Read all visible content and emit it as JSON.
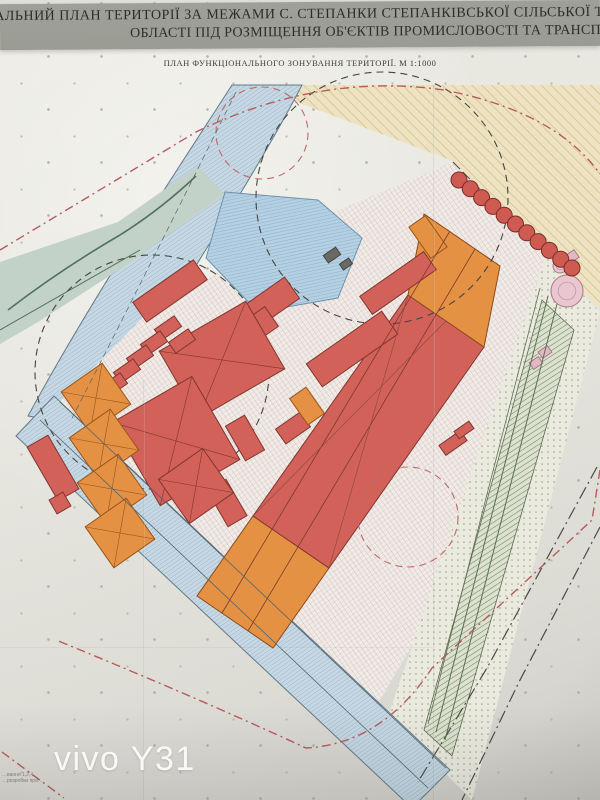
{
  "header": {
    "line1": "ТАЛЬНИЙ ПЛАН ТЕРИТОРІЇ ЗА МЕЖАМИ С. СТЕПАНКИ СТЕПАНКІВСЬКОЇ СІЛЬСЬКОЇ ТЕРИТОР",
    "line2": "ОБЛАСТІ ПІД РОЗМІЩЕННЯ ОБ'ЄКТІВ ПРОМИСЛОВОСТІ ТА ТРАНСПОРТ",
    "subtitle": "ПЛАН ФУНКЦІОНАЛЬНОГО ЗОНУВАННЯ ТЕРИТОРІЇ. М 1:1000"
  },
  "photo": {
    "watermark": "vivo Y31"
  },
  "footnote": {
    "line1": "…вання 1,2,4",
    "line2": "…розробки про…"
  },
  "palette": {
    "paper": "#e6e5de",
    "title_band": "#a2a39b",
    "cream_zone": "#ede3c3",
    "road_blue": "#c6d8e3",
    "pond_blue": "#b5d0e2",
    "building_red": "#d2615a",
    "building_orange": "#e59143",
    "tree_red": "#ce5a52",
    "boundary_red": "#b85b5e",
    "boundary_black": "#4b4b45",
    "marker_fill": "#f8f7f1"
  },
  "map": {
    "markers": [
      {
        "n": "43",
        "x": 184,
        "y": 195
      },
      {
        "n": "36",
        "x": 232,
        "y": 244
      },
      {
        "n": "37",
        "x": 195,
        "y": 258
      },
      {
        "n": "42",
        "x": 131,
        "y": 259
      },
      {
        "n": "17",
        "x": 213,
        "y": 278
      },
      {
        "n": "38",
        "x": 237,
        "y": 278
      },
      {
        "n": "9",
        "x": 170,
        "y": 278
      },
      {
        "n": "40",
        "x": 115,
        "y": 297
      },
      {
        "n": "39",
        "x": 73,
        "y": 317
      },
      {
        "n": "16",
        "x": 113,
        "y": 340
      },
      {
        "n": "13",
        "x": 152,
        "y": 339
      },
      {
        "n": "38",
        "x": 4,
        "y": 366
      },
      {
        "n": "38",
        "x": 43,
        "y": 377
      },
      {
        "n": "33",
        "x": 56,
        "y": 412
      },
      {
        "n": "14",
        "x": 105,
        "y": 387
      },
      {
        "n": "14",
        "x": 112,
        "y": 432
      },
      {
        "n": "18",
        "x": 66,
        "y": 432
      },
      {
        "n": "19",
        "x": 53,
        "y": 463
      },
      {
        "n": "27",
        "x": 37,
        "y": 485
      },
      {
        "n": "20",
        "x": 62,
        "y": 499
      },
      {
        "n": "14",
        "x": 120,
        "y": 477
      },
      {
        "n": "14",
        "x": 128,
        "y": 522
      },
      {
        "n": "33",
        "x": 163,
        "y": 511
      },
      {
        "n": "30",
        "x": 183,
        "y": 532
      },
      {
        "n": "16",
        "x": 421,
        "y": 197
      },
      {
        "n": "15",
        "x": 507,
        "y": 213
      },
      {
        "n": "26",
        "x": 562,
        "y": 250
      },
      {
        "n": "10",
        "x": 427,
        "y": 226
      },
      {
        "n": "9",
        "x": 398,
        "y": 268
      },
      {
        "n": "3",
        "x": 433,
        "y": 267
      },
      {
        "n": "5",
        "x": 455,
        "y": 278
      },
      {
        "n": "8",
        "x": 488,
        "y": 298
      },
      {
        "n": "34",
        "x": 519,
        "y": 323
      },
      {
        "n": "9",
        "x": 258,
        "y": 299
      },
      {
        "n": "9",
        "x": 239,
        "y": 326
      },
      {
        "n": "11",
        "x": 218,
        "y": 354
      },
      {
        "n": "12",
        "x": 169,
        "y": 425
      },
      {
        "n": "32",
        "x": 244,
        "y": 434
      },
      {
        "n": "7",
        "x": 292,
        "y": 427
      },
      {
        "n": "28",
        "x": 263,
        "y": 463
      },
      {
        "n": "9",
        "x": 352,
        "y": 333
      },
      {
        "n": "3",
        "x": 311,
        "y": 403
      },
      {
        "n": "9",
        "x": 230,
        "y": 503
      },
      {
        "n": "1",
        "x": 269,
        "y": 497
      },
      {
        "n": "4",
        "x": 289,
        "y": 509
      },
      {
        "n": "6",
        "x": 320,
        "y": 532
      },
      {
        "n": "2",
        "x": 235,
        "y": 550
      },
      {
        "n": "5",
        "x": 241,
        "y": 578
      },
      {
        "n": "8",
        "x": 273,
        "y": 601
      },
      {
        "n": "26",
        "x": 488,
        "y": 387
      },
      {
        "n": "22",
        "x": 472,
        "y": 449
      },
      {
        "n": "23",
        "x": 446,
        "y": 457
      },
      {
        "n": "23",
        "x": 427,
        "y": 471
      },
      {
        "n": "25",
        "x": 408,
        "y": 517
      },
      {
        "n": "41",
        "x": 523,
        "y": 494
      },
      {
        "n": "16",
        "x": 183,
        "y": 580
      },
      {
        "n": "42",
        "x": 113,
        "y": 578
      },
      {
        "n": "43",
        "x": 180,
        "y": 620
      },
      {
        "n": "29",
        "x": 231,
        "y": 622
      }
    ],
    "zones": [
      {
        "n": "zone-agricultural-cream",
        "p": "148,85 600,85 600,308 546,258 453,161 252,85",
        "f": "hatchCream"
      },
      {
        "n": "zone-highway-top",
        "d": "M 232,85 L 302,85 C 245,195 155,325 98,428 L 28,416 C 92,298 172,178 232,85 Z",
        "f": "hatchRoad",
        "s": "#64798a",
        "sw": 1
      },
      {
        "n": "zone-river-strip",
        "p": "0,262 118,222 198,166 224,194 128,264 38,322 0,344",
        "fill": "#c2d2c9"
      },
      {
        "n": "zone-site-crosshatch",
        "p": "150,310 310,222 453,162 546,256 462,560 380,700 330,730 60,402",
        "f": "crossHatch"
      },
      {
        "n": "zone-buffer-dotted",
        "p": "546,256 600,312 472,800 388,716",
        "f": "dotZone"
      },
      {
        "n": "zone-green-belt",
        "p": "542,300 574,330 452,756 424,730",
        "f": "hatchGreen",
        "s": "#5c6b52",
        "sw": 0.8
      },
      {
        "n": "zone-road-bottom",
        "p": "54,396 450,770 412,808 16,436",
        "f": "hatchRoad",
        "s": "#64798a",
        "sw": 1
      },
      {
        "n": "zone-pond",
        "p": "225,192 318,200 362,238 338,298 258,312 206,258",
        "f": "hatchPond",
        "s": "#6c93ad",
        "sw": 1
      },
      {
        "n": "building-band-sw-orange",
        "p": "197,596 273,648 329,568 253,516",
        "fill": "#e59143",
        "s": "#8a4a1e",
        "sw": 1
      },
      {
        "n": "building-band-red",
        "p": "253,516 329,568 484,347 408,295",
        "fill": "#d2615a",
        "s": "#81362e",
        "sw": 1
      },
      {
        "n": "building-band-ne-orange",
        "p": "408,295 484,347 500,266 424,214",
        "fill": "#e59143",
        "s": "#8a4a1e",
        "sw": 1
      }
    ],
    "buildings": [
      [
        170,
        291,
        74,
        24,
        -35,
        "r",
        0
      ],
      [
        256,
        313,
        88,
        26,
        -35,
        "r",
        0
      ],
      [
        238,
        340,
        82,
        24,
        -35,
        "r",
        0
      ],
      [
        398,
        283,
        78,
        22,
        -35,
        "r",
        0
      ],
      [
        352,
        349,
        92,
        28,
        -35,
        "r",
        0
      ],
      [
        222,
        360,
        100,
        78,
        -30,
        "r",
        1
      ],
      [
        176,
        441,
        92,
        96,
        -30,
        "r",
        1
      ],
      [
        168,
        328,
        24,
        13,
        -35,
        "r",
        0
      ],
      [
        182,
        341,
        24,
        13,
        -35,
        "r",
        0
      ],
      [
        154,
        343,
        24,
        13,
        -35,
        "r",
        0
      ],
      [
        140,
        357,
        24,
        13,
        -35,
        "r",
        0
      ],
      [
        127,
        371,
        24,
        13,
        -35,
        "r",
        0
      ],
      [
        114,
        385,
        24,
        13,
        -35,
        "r",
        0
      ],
      [
        227,
        503,
        22,
        42,
        -30,
        "r",
        0
      ],
      [
        196,
        486,
        54,
        54,
        -35,
        "r",
        1
      ],
      [
        245,
        438,
        22,
        40,
        -30,
        "r",
        0
      ],
      [
        293,
        428,
        30,
        18,
        -35,
        "r",
        0
      ],
      [
        453,
        443,
        26,
        12,
        -35,
        "r",
        0
      ],
      [
        464,
        430,
        18,
        9,
        -35,
        "r",
        0
      ],
      [
        53,
        468,
        24,
        62,
        -30,
        "r",
        0
      ],
      [
        60,
        503,
        16,
        16,
        -30,
        "r",
        0
      ],
      [
        96,
        398,
        50,
        50,
        -35,
        "o",
        1
      ],
      [
        104,
        444,
        50,
        50,
        -35,
        "o",
        1
      ],
      [
        112,
        489,
        50,
        50,
        -35,
        "o",
        1
      ],
      [
        120,
        533,
        50,
        50,
        -35,
        "o",
        1
      ],
      [
        428,
        237,
        20,
        38,
        -35,
        "o",
        0
      ],
      [
        307,
        406,
        20,
        32,
        -35,
        "o",
        0
      ],
      [
        570,
        258,
        16,
        9,
        -35,
        "p",
        0
      ],
      [
        545,
        352,
        11,
        8,
        -35,
        "p",
        0
      ],
      [
        536,
        363,
        11,
        8,
        -35,
        "p",
        0
      ],
      [
        332,
        255,
        15,
        9,
        -35,
        "g",
        0
      ],
      [
        346,
        264,
        11,
        7,
        -35,
        "g",
        0
      ]
    ],
    "tanks": [
      {
        "x": 567,
        "y": 291,
        "r": 16
      },
      {
        "x": 560,
        "y": 266,
        "r": 7
      }
    ],
    "trees": {
      "x1": 459,
      "y1": 180,
      "x2": 572,
      "y2": 268,
      "count": 11,
      "r": 8
    },
    "dashed_circles": [
      {
        "cx": 152,
        "cy": 372,
        "r": 117,
        "s": "#45453f"
      },
      {
        "cx": 382,
        "cy": 198,
        "r": 126,
        "s": "#45453f"
      },
      {
        "cx": 408,
        "cy": 517,
        "r": 50,
        "s": "#c06a6a"
      },
      {
        "cx": 262,
        "cy": 133,
        "r": 46,
        "s": "#c06a6a"
      }
    ],
    "paths": [
      {
        "d": "M 0,250 L 196,132 Q 320,72 444,90 Q 556,112 600,174",
        "s": "#b85b5e",
        "w": 1.4,
        "da": "9 4 2 4"
      },
      {
        "d": "M 600,470 L 592,520 L 432,668 Q 382,744 306,748 Q 198,698 56,640",
        "s": "#b85b5e",
        "w": 1.4,
        "da": "9 4 2 4"
      },
      {
        "d": "M 2,752 L 64,798",
        "s": "#b85b5e",
        "w": 1.4,
        "da": "9 4 2 4"
      },
      {
        "d": "M 597,467 L 487,668 L 418,782",
        "s": "#4b4b45",
        "w": 1.2,
        "da": "13 4 2 4"
      },
      {
        "d": "M 600,527 L 519,682 L 462,800",
        "s": "#4b4b45",
        "w": 1.2,
        "da": "13 4 2 4"
      },
      {
        "d": "M 453,162 L 546,256",
        "s": "#4b4b45",
        "w": 1,
        "da": "10 4"
      },
      {
        "d": "M 222,613 L 450,231",
        "s": "#7a3a2c",
        "w": 0.8,
        "da": ""
      },
      {
        "d": "M 248,631 L 475,249",
        "s": "#7a3a2c",
        "w": 0.8,
        "da": ""
      },
      {
        "d": "M 253,516 L 446,321",
        "s": "#8a4a3a",
        "w": 0.6,
        "da": ""
      },
      {
        "d": "M 408,295 L 329,568",
        "s": "#8a4a3a",
        "w": 0.6,
        "da": ""
      },
      {
        "d": "M 548,296 L 436,732",
        "s": "#5a7050",
        "w": 1,
        "da": ""
      },
      {
        "d": "M 557,304 L 445,740",
        "s": "#5a7050",
        "w": 1,
        "da": ""
      },
      {
        "d": "M 540,288 L 428,724",
        "s": "#5a7050",
        "w": 0.8,
        "da": ""
      },
      {
        "d": "M 60,402 L 446,768",
        "s": "#54646e",
        "w": 0.8,
        "da": ""
      },
      {
        "d": "M 40,420 L 428,788",
        "s": "#54646e",
        "w": 0.8,
        "da": ""
      },
      {
        "d": "M 236,92 C 185,195 125,315 72,418",
        "s": "#54646e",
        "w": 0.7,
        "da": "6 4"
      },
      {
        "d": "M 8,310 Q 60,270 120,235 Q 160,210 196,176",
        "s": "#51705e",
        "w": 1.6,
        "da": ""
      },
      {
        "d": "M 0,330 Q 70,290 140,250",
        "s": "#51705e",
        "w": 1,
        "da": ""
      }
    ],
    "road_labels": [
      {
        "t": "автодорога",
        "x": 128,
        "y": 262,
        "rot": -59,
        "size": 6
      },
      {
        "t": "автодорога",
        "x": 548,
        "y": 672,
        "rot": 43,
        "size": 6
      },
      {
        "t": "в бік с. Червона Слобода",
        "x": 378,
        "y": 738,
        "rot": 38,
        "size": 5
      }
    ]
  }
}
